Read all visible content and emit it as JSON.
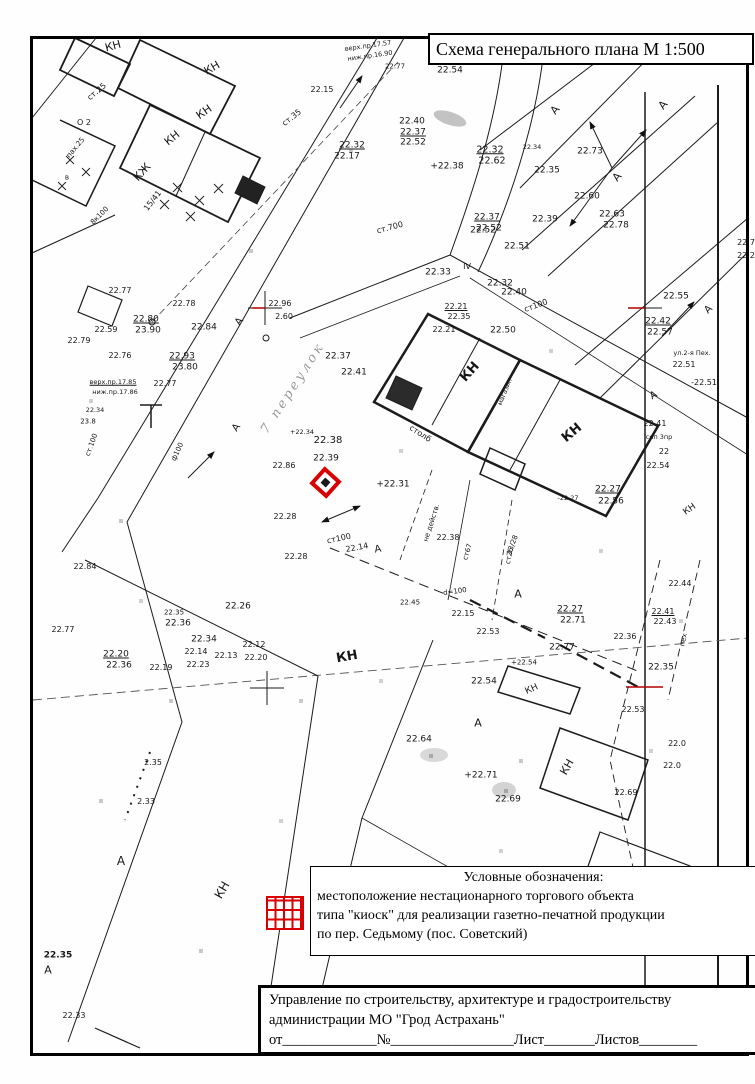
{
  "title_box": {
    "text": "Схема генерального плана М 1:500"
  },
  "legend": {
    "heading": "Условные обозначения:",
    "lines": [
      "местоположение нестационарного торгового объекта",
      "типа \"киоск\" для реализации газетно-печатной продукции",
      "по пер. Седьмому (пос. Советский)"
    ],
    "symbol_color": "#d80000"
  },
  "stamp": {
    "line1": "Управление по строительству, архитектуре и градостроительству",
    "line2": "администрации МО \"Грод Астрахань\"",
    "line3": "от_____________№_________________Лист_______Листов________"
  },
  "marker": {
    "meaning": "kiosk location",
    "color": "#d80000",
    "x": 327,
    "y": 484
  },
  "map": {
    "scale": "1:500",
    "labels": [
      {
        "t": "КН",
        "x": 113,
        "y": 46,
        "r": -15,
        "s": 11
      },
      {
        "t": "КН",
        "x": 212,
        "y": 68,
        "r": -30,
        "s": 11
      },
      {
        "t": "КН",
        "x": 204,
        "y": 112,
        "r": -35,
        "s": 11
      },
      {
        "t": "КН",
        "x": 172,
        "y": 138,
        "r": -40,
        "s": 11
      },
      {
        "t": "КЖ",
        "x": 142,
        "y": 172,
        "r": -48,
        "s": 11
      },
      {
        "t": "15/41",
        "x": 153,
        "y": 201,
        "r": -52,
        "s": 8
      },
      {
        "t": "ст.25",
        "x": 97,
        "y": 92,
        "r": -40,
        "s": 8
      },
      {
        "t": "О 2",
        "x": 84,
        "y": 123,
        "s": 8
      },
      {
        "t": "пах.25",
        "x": 76,
        "y": 148,
        "r": -50,
        "s": 7
      },
      {
        "t": "в",
        "x": 67,
        "y": 178,
        "s": 7
      },
      {
        "t": "8к100",
        "x": 100,
        "y": 216,
        "r": -45,
        "s": 7
      },
      {
        "t": "ст.35",
        "x": 292,
        "y": 118,
        "r": -38,
        "s": 8
      },
      {
        "t": "22.15",
        "x": 322,
        "y": 90,
        "s": 8
      },
      {
        "t": "верх.пр.17.57",
        "x": 368,
        "y": 46,
        "r": -8,
        "s": 6.5
      },
      {
        "t": "ниж.пр.16.90",
        "x": 370,
        "y": 56,
        "r": -8,
        "s": 6.5
      },
      {
        "t": "22.77",
        "x": 395,
        "y": 67,
        "s": 7
      },
      {
        "t": "22.54",
        "x": 450,
        "y": 71,
        "s": 9
      },
      {
        "t": "22.40",
        "x": 412,
        "y": 122,
        "s": 9
      },
      {
        "t": "22.37",
        "x": 413,
        "y": 133,
        "s": 9,
        "u": 1
      },
      {
        "t": "22.52",
        "x": 413,
        "y": 143,
        "s": 9
      },
      {
        "t": "22.32",
        "x": 352,
        "y": 146,
        "s": 9,
        "u": 1
      },
      {
        "t": "22.17",
        "x": 347,
        "y": 157,
        "s": 9
      },
      {
        "t": "+22.38",
        "x": 447,
        "y": 167,
        "s": 9
      },
      {
        "t": "22.34",
        "x": 532,
        "y": 147,
        "s": 6.5
      },
      {
        "t": "22.32",
        "x": 490,
        "y": 150,
        "s": 9.5,
        "u": 1
      },
      {
        "t": "22.62",
        "x": 492,
        "y": 161,
        "s": 9.5
      },
      {
        "t": "22.73",
        "x": 590,
        "y": 152,
        "s": 9
      },
      {
        "t": "22.35",
        "x": 547,
        "y": 171,
        "s": 9
      },
      {
        "t": "22.60",
        "x": 587,
        "y": 197,
        "s": 9
      },
      {
        "t": "А",
        "x": 555,
        "y": 110,
        "r": -50,
        "s": 11
      },
      {
        "t": "А",
        "x": 663,
        "y": 105,
        "r": -50,
        "s": 11
      },
      {
        "t": "А",
        "x": 617,
        "y": 177,
        "r": -50,
        "s": 11
      },
      {
        "t": "22.63",
        "x": 612,
        "y": 215,
        "s": 9
      },
      {
        "t": "22.78",
        "x": 616,
        "y": 226,
        "s": 9
      },
      {
        "t": "22.37",
        "x": 487,
        "y": 218,
        "s": 9,
        "u": 1
      },
      {
        "t": "22.52",
        "x": 489,
        "y": 229,
        "s": 9
      },
      {
        "t": "22.39",
        "x": 545,
        "y": 220,
        "s": 9
      },
      {
        "t": "22.51",
        "x": 517,
        "y": 247,
        "s": 9
      },
      {
        "t": "22.7",
        "x": 746,
        "y": 243,
        "s": 8
      },
      {
        "t": "22.2",
        "x": 746,
        "y": 256,
        "s": 8
      },
      {
        "t": "22.55",
        "x": 676,
        "y": 297,
        "s": 9
      },
      {
        "t": "А",
        "x": 709,
        "y": 310,
        "r": -45,
        "s": 10
      },
      {
        "t": "22.42",
        "x": 658,
        "y": 322,
        "s": 9,
        "u": 1
      },
      {
        "t": "22.57",
        "x": 660,
        "y": 333,
        "s": 9
      },
      {
        "t": "ул.2-я Пех.",
        "x": 692,
        "y": 353,
        "s": 6.5
      },
      {
        "t": "22.51",
        "x": 684,
        "y": 365,
        "s": 8
      },
      {
        "t": "-22.51",
        "x": 704,
        "y": 383,
        "s": 8
      },
      {
        "t": "А",
        "x": 654,
        "y": 396,
        "r": -30,
        "s": 10
      },
      {
        "t": "22.41",
        "x": 655,
        "y": 424,
        "s": 8
      },
      {
        "t": "сип 3пр",
        "x": 659,
        "y": 437,
        "s": 6.5
      },
      {
        "t": "22",
        "x": 664,
        "y": 452,
        "s": 8
      },
      {
        "t": "22.54",
        "x": 658,
        "y": 466,
        "s": 8
      },
      {
        "t": "22.27",
        "x": 608,
        "y": 490,
        "s": 9,
        "u": 1
      },
      {
        "t": "22.56",
        "x": 611,
        "y": 502,
        "s": 9
      },
      {
        "t": "-22.27",
        "x": 568,
        "y": 498,
        "s": 6.5
      },
      {
        "t": "КН",
        "x": 690,
        "y": 510,
        "r": -35,
        "s": 9
      },
      {
        "t": "22.84",
        "x": 204,
        "y": 328,
        "s": 9
      },
      {
        "t": "22.77",
        "x": 120,
        "y": 291,
        "s": 8
      },
      {
        "t": "22.78",
        "x": 184,
        "y": 304,
        "s": 8
      },
      {
        "t": "22.80",
        "x": 146,
        "y": 320,
        "s": 9,
        "u": 1
      },
      {
        "t": "23.90",
        "x": 148,
        "y": 331,
        "s": 9
      },
      {
        "t": "22.59",
        "x": 106,
        "y": 330,
        "s": 8
      },
      {
        "t": "22.79",
        "x": 79,
        "y": 341,
        "s": 8
      },
      {
        "t": "22.76",
        "x": 120,
        "y": 356,
        "s": 8
      },
      {
        "t": "22.93",
        "x": 182,
        "y": 357,
        "s": 9,
        "u": 1
      },
      {
        "t": "23.80",
        "x": 185,
        "y": 368,
        "s": 9
      },
      {
        "t": "верх.пр.17.85",
        "x": 113,
        "y": 382,
        "s": 6.5,
        "u": 1
      },
      {
        "t": "ниж.пр.17.86",
        "x": 115,
        "y": 392,
        "s": 6.5
      },
      {
        "t": "22.77",
        "x": 165,
        "y": 384,
        "s": 8
      },
      {
        "t": "22.34",
        "x": 95,
        "y": 410,
        "s": 6.5
      },
      {
        "t": "23.8",
        "x": 88,
        "y": 422,
        "s": 7
      },
      {
        "t": "ст.100",
        "x": 92,
        "y": 445,
        "r": -70,
        "s": 7
      },
      {
        "t": "ф100",
        "x": 178,
        "y": 452,
        "r": -65,
        "s": 7
      },
      {
        "t": "А",
        "x": 240,
        "y": 322,
        "r": -55,
        "s": 10
      },
      {
        "t": "А",
        "x": 237,
        "y": 428,
        "r": -55,
        "s": 10
      },
      {
        "t": "7 переулок",
        "x": 293,
        "y": 388,
        "r": -57,
        "s": 13,
        "c": "hand"
      },
      {
        "t": "22.96",
        "x": 280,
        "y": 304,
        "s": 8
      },
      {
        "t": "2.60",
        "x": 284,
        "y": 317,
        "s": 8
      },
      {
        "t": "22.37",
        "x": 338,
        "y": 357,
        "s": 9
      },
      {
        "t": "22.41",
        "x": 354,
        "y": 373,
        "s": 9
      },
      {
        "t": "+22.34",
        "x": 302,
        "y": 432,
        "s": 6.5
      },
      {
        "t": "22.38",
        "x": 328,
        "y": 441,
        "s": 10
      },
      {
        "t": "22.39",
        "x": 326,
        "y": 459,
        "s": 9
      },
      {
        "t": "22.86",
        "x": 284,
        "y": 466,
        "s": 8
      },
      {
        "t": "+22.31",
        "x": 393,
        "y": 485,
        "s": 9
      },
      {
        "t": "столб",
        "x": 420,
        "y": 434,
        "r": 33,
        "s": 8
      },
      {
        "t": "ст100",
        "x": 536,
        "y": 306,
        "r": -20,
        "s": 8
      },
      {
        "t": "22.33",
        "x": 438,
        "y": 273,
        "s": 9
      },
      {
        "t": "IV",
        "x": 467,
        "y": 267,
        "s": 8
      },
      {
        "t": "22.32",
        "x": 500,
        "y": 284,
        "s": 9
      },
      {
        "t": "22.40",
        "x": 514,
        "y": 293,
        "s": 9
      },
      {
        "t": "22.21",
        "x": 456,
        "y": 307,
        "s": 8,
        "u": 1
      },
      {
        "t": "22.35",
        "x": 459,
        "y": 317,
        "s": 8
      },
      {
        "t": "22.21",
        "x": 444,
        "y": 330,
        "s": 8
      },
      {
        "t": "22.50",
        "x": 503,
        "y": 331,
        "s": 9
      },
      {
        "t": "22.52",
        "x": 483,
        "y": 231,
        "s": 9
      },
      {
        "t": "КН",
        "x": 470,
        "y": 372,
        "r": -48,
        "s": 13,
        "b": 1
      },
      {
        "t": "КН",
        "x": 572,
        "y": 433,
        "r": -40,
        "s": 13,
        "b": 1
      },
      {
        "t": "магазин",
        "x": 505,
        "y": 392,
        "r": -68,
        "s": 6.5
      },
      {
        "t": "ст.700",
        "x": 390,
        "y": 228,
        "r": -15,
        "s": 8
      },
      {
        "t": "не действ.",
        "x": 432,
        "y": 523,
        "r": -72,
        "s": 7
      },
      {
        "t": "ст67",
        "x": 468,
        "y": 552,
        "r": -72,
        "s": 7
      },
      {
        "t": "ст26",
        "x": 510,
        "y": 556,
        "r": -78,
        "s": 7
      },
      {
        "t": "d=100",
        "x": 455,
        "y": 592,
        "r": -8,
        "s": 7
      },
      {
        "t": "22.45",
        "x": 410,
        "y": 603,
        "s": 7
      },
      {
        "t": "22.14",
        "x": 357,
        "y": 548,
        "r": -10,
        "s": 8
      },
      {
        "t": "А",
        "x": 378,
        "y": 550,
        "r": -10,
        "s": 10
      },
      {
        "t": "22.28",
        "x": 285,
        "y": 517,
        "s": 8
      },
      {
        "t": "22.28",
        "x": 296,
        "y": 557,
        "s": 8
      },
      {
        "t": "ст100",
        "x": 339,
        "y": 539,
        "r": -12,
        "s": 8
      },
      {
        "t": "22.38",
        "x": 448,
        "y": 538,
        "s": 8
      },
      {
        "t": "13/28",
        "x": 513,
        "y": 545,
        "r": -70,
        "s": 7
      },
      {
        "t": "22.15",
        "x": 463,
        "y": 614,
        "s": 8
      },
      {
        "t": "А",
        "x": 518,
        "y": 594,
        "s": 11
      },
      {
        "t": "22.27",
        "x": 570,
        "y": 610,
        "s": 9,
        "u": 1
      },
      {
        "t": "22.71",
        "x": 573,
        "y": 621,
        "s": 9
      },
      {
        "t": "22.77",
        "x": 562,
        "y": 648,
        "s": 9
      },
      {
        "t": "22.53",
        "x": 488,
        "y": 632,
        "s": 8
      },
      {
        "t": "22.36",
        "x": 625,
        "y": 637,
        "s": 8
      },
      {
        "t": "+22.54",
        "x": 524,
        "y": 663,
        "s": 7
      },
      {
        "t": "22.54",
        "x": 484,
        "y": 682,
        "s": 9
      },
      {
        "t": "КН",
        "x": 532,
        "y": 690,
        "r": -25,
        "s": 9
      },
      {
        "t": "22.44",
        "x": 680,
        "y": 584,
        "s": 8
      },
      {
        "t": "22.41",
        "x": 663,
        "y": 612,
        "s": 8,
        "u": 1
      },
      {
        "t": "22.43",
        "x": 665,
        "y": 622,
        "s": 8
      },
      {
        "t": "пех",
        "x": 684,
        "y": 640,
        "r": -78,
        "s": 7
      },
      {
        "t": "22.35",
        "x": 661,
        "y": 668,
        "s": 9
      },
      {
        "t": "22.53",
        "x": 633,
        "y": 710,
        "s": 8
      },
      {
        "t": "22.0",
        "x": 677,
        "y": 744,
        "s": 8
      },
      {
        "t": "22.0",
        "x": 672,
        "y": 766,
        "s": 8
      },
      {
        "t": "22.69",
        "x": 626,
        "y": 793,
        "s": 8
      },
      {
        "t": "22.26",
        "x": 238,
        "y": 607,
        "s": 9
      },
      {
        "t": "22.35",
        "x": 174,
        "y": 613,
        "s": 7
      },
      {
        "t": "22.36",
        "x": 178,
        "y": 624,
        "s": 9
      },
      {
        "t": "22.34",
        "x": 204,
        "y": 640,
        "s": 9
      },
      {
        "t": "22.12",
        "x": 254,
        "y": 645,
        "s": 8
      },
      {
        "t": "22.14",
        "x": 196,
        "y": 652,
        "s": 8
      },
      {
        "t": "22.13",
        "x": 226,
        "y": 656,
        "s": 8
      },
      {
        "t": "22.20",
        "x": 256,
        "y": 658,
        "s": 8
      },
      {
        "t": "22.20",
        "x": 116,
        "y": 655,
        "s": 9,
        "u": 1
      },
      {
        "t": "22.36",
        "x": 119,
        "y": 666,
        "s": 9
      },
      {
        "t": "22.23",
        "x": 198,
        "y": 665,
        "s": 8
      },
      {
        "t": "22.19",
        "x": 161,
        "y": 668,
        "s": 8
      },
      {
        "t": "22.77",
        "x": 63,
        "y": 630,
        "s": 8
      },
      {
        "t": "22.84",
        "x": 85,
        "y": 567,
        "s": 8
      },
      {
        "t": "КН",
        "x": 347,
        "y": 657,
        "r": -10,
        "s": 13,
        "b": 1
      },
      {
        "t": "А",
        "x": 478,
        "y": 723,
        "s": 11
      },
      {
        "t": "22.64",
        "x": 419,
        "y": 740,
        "s": 9
      },
      {
        "t": "+22.71",
        "x": 481,
        "y": 776,
        "s": 9
      },
      {
        "t": "22.69",
        "x": 508,
        "y": 800,
        "s": 9
      },
      {
        "t": "КН",
        "x": 567,
        "y": 767,
        "r": -60,
        "s": 11
      },
      {
        "t": "2.35",
        "x": 153,
        "y": 763,
        "s": 8
      },
      {
        "t": "2.33",
        "x": 146,
        "y": 802,
        "s": 8
      },
      {
        "t": "А",
        "x": 121,
        "y": 861,
        "s": 12
      },
      {
        "t": "КН",
        "x": 222,
        "y": 890,
        "r": -60,
        "s": 12
      },
      {
        "t": "22.35",
        "x": 58,
        "y": 956,
        "s": 9,
        "b": 1
      },
      {
        "t": "А",
        "x": 48,
        "y": 970,
        "s": 11
      },
      {
        "t": "22.33",
        "x": 74,
        "y": 1016,
        "s": 8
      }
    ]
  }
}
